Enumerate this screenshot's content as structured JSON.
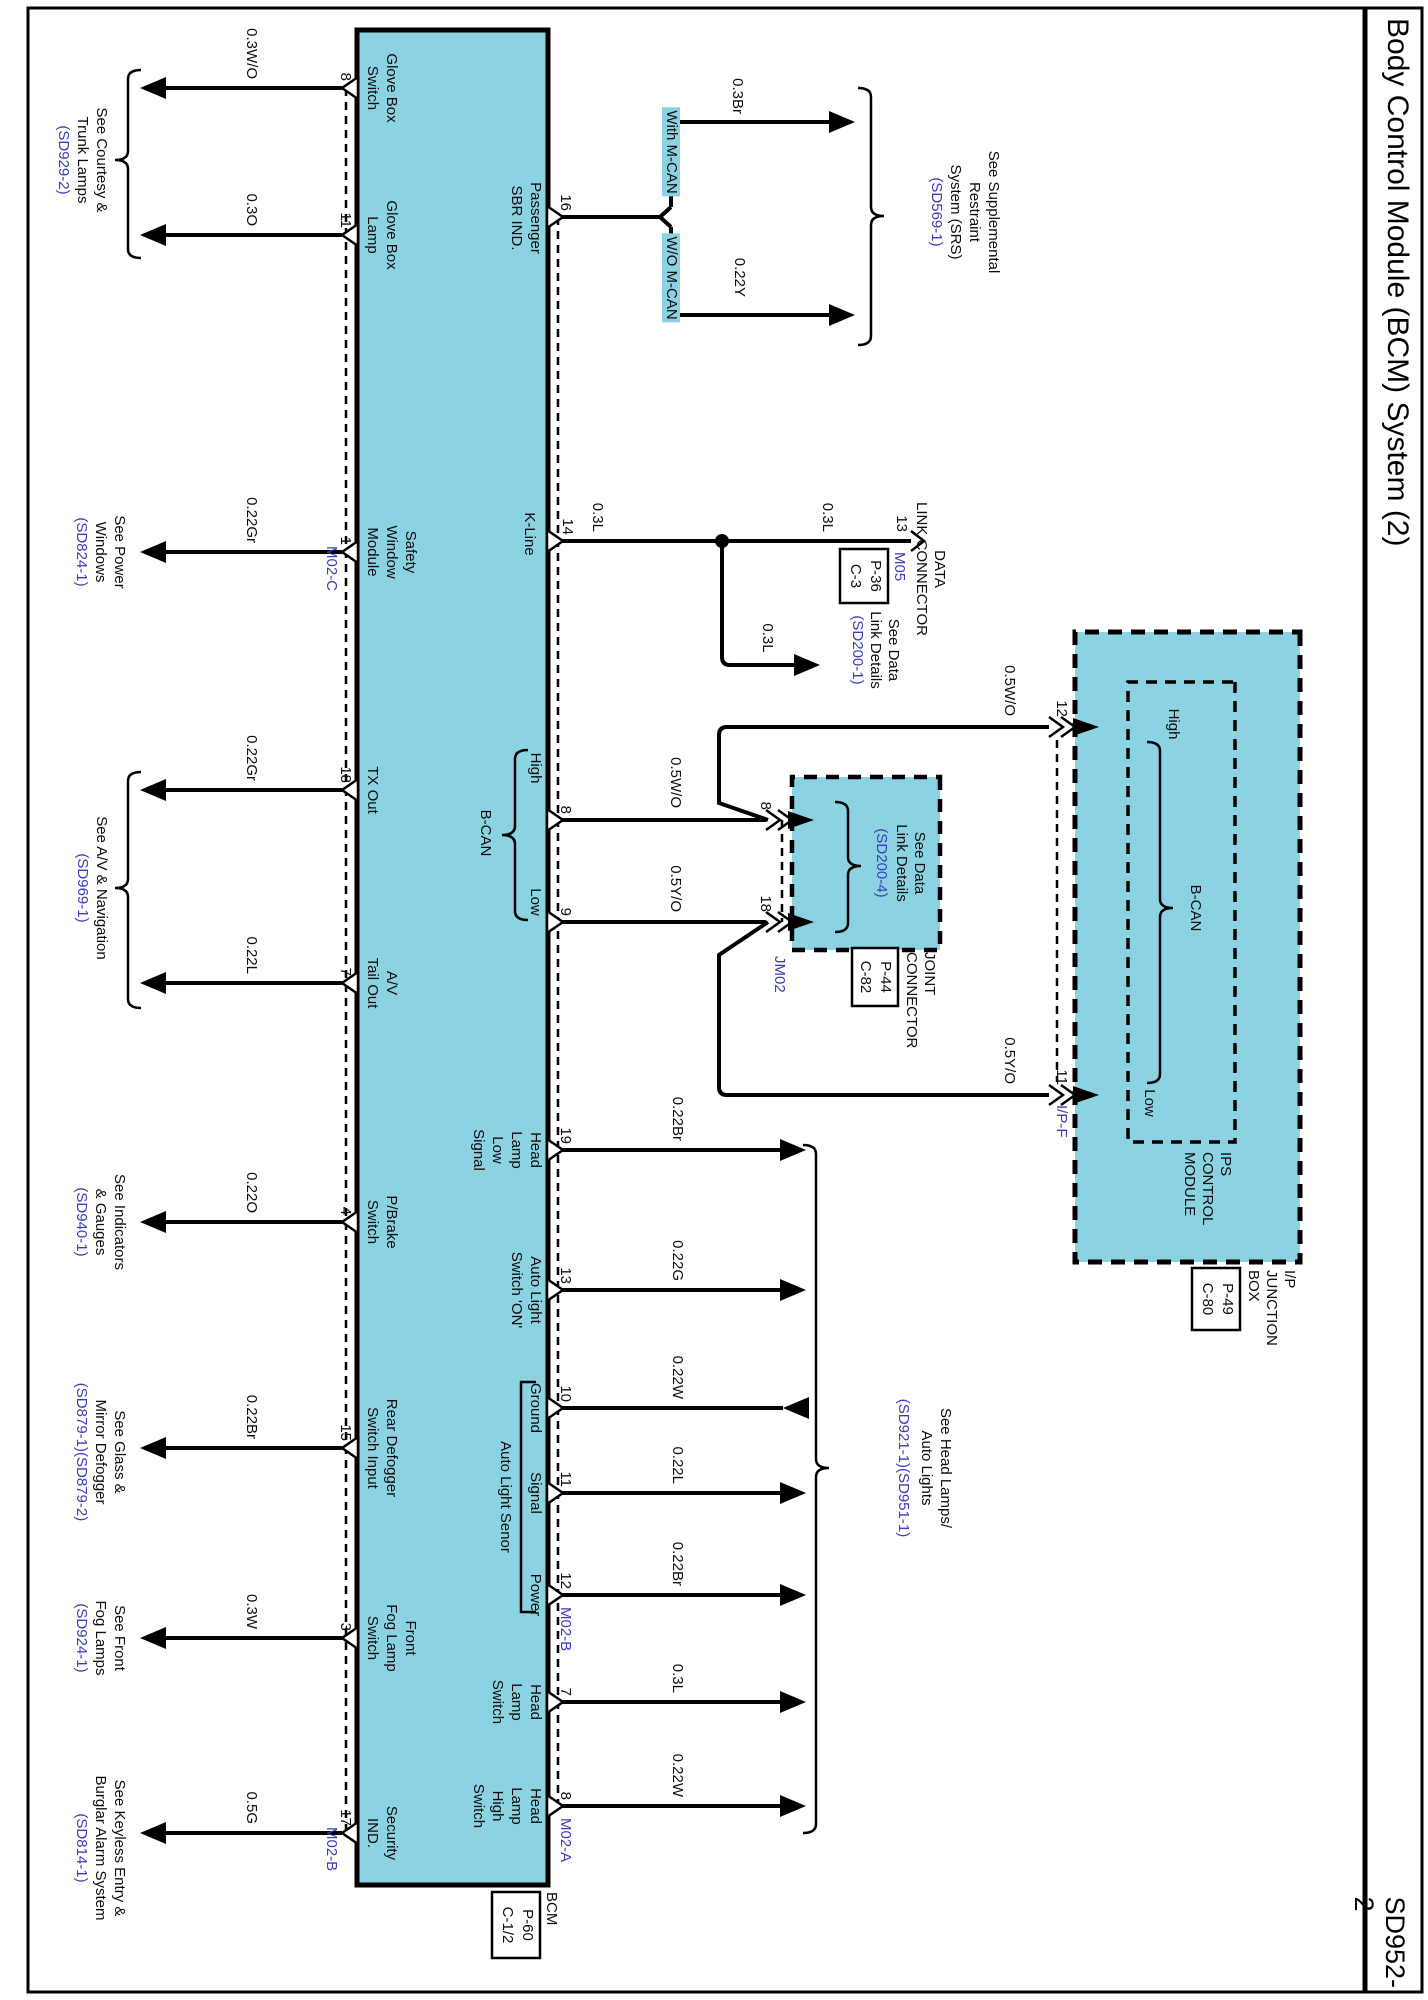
{
  "page": {
    "title": "Body Control Module (BCM) System (2)",
    "code": "SD952-2"
  },
  "colors": {
    "module_fill": "#8bd2e2",
    "reference_blue": "#3b3bbc",
    "wire_black": "#000000"
  },
  "bcm": {
    "label": "BCM",
    "connector_box": [
      "P-60",
      "C-1/2"
    ],
    "bottom_pins": [
      {
        "num": "8",
        "wire": "0.3W/O",
        "name": [
          "Glove Box",
          "Switch"
        ]
      },
      {
        "num": "11",
        "wire": "0.3O",
        "name": [
          "Glove Box",
          "Lamp"
        ]
      },
      {
        "num": "1",
        "wire": "0.22Gr",
        "name": [
          "Safety",
          "Window",
          "Module"
        ],
        "conn": "M02-C"
      },
      {
        "num": "18",
        "wire": "0.22Gr",
        "name": [
          "TX Out"
        ]
      },
      {
        "num": "7",
        "wire": "0.22L",
        "name": [
          "A/V",
          "Tail Out"
        ]
      },
      {
        "num": "4",
        "wire": "0.22O",
        "name": [
          "P/Brake",
          "Switch"
        ]
      },
      {
        "num": "15",
        "wire": "0.22Br",
        "name": [
          "Rear Defogger",
          "Switch Input"
        ]
      },
      {
        "num": "3",
        "wire": "0.3W",
        "name": [
          "Front",
          "Fog Lamp",
          "Switch"
        ]
      },
      {
        "num": "17",
        "wire": "0.5G",
        "name": [
          "Security",
          "IND."
        ],
        "conn": "M02-B"
      }
    ],
    "bottom_refs": [
      {
        "lines": [
          "See Courtesy &",
          "Trunk Lamps"
        ],
        "code": "(SD929-2)"
      },
      {
        "lines": [
          "See Power",
          "Windows"
        ],
        "code": "(SD824-1)"
      },
      {
        "lines": [
          "See A/V & Navigation"
        ],
        "code": "(SD969-1)"
      },
      {
        "lines": [
          "See Indicators",
          "& Gauges"
        ],
        "code": "(SD940-1)"
      },
      {
        "lines": [
          "See Glass &",
          "Mirror Defogger"
        ],
        "code": "(SD879-1)(SD879-2)"
      },
      {
        "lines": [
          "See Front",
          "Fog Lamps"
        ],
        "code": "(SD924-1)"
      },
      {
        "lines": [
          "See Keyless Entry &",
          "Burglar Alarm System"
        ],
        "code": "(SD814-1)"
      }
    ],
    "headlamp_pins": [
      {
        "num": "19",
        "wire": "0.22Br",
        "name": [
          "Head",
          "Lamp",
          "Low",
          "Signal"
        ]
      },
      {
        "num": "13",
        "wire": "0.22G",
        "name": [
          "Auto Light",
          "Switch 'ON'"
        ]
      },
      {
        "num": "10",
        "wire": "0.22W",
        "name": [
          "Ground"
        ],
        "dir": "in"
      },
      {
        "num": "11",
        "wire": "0.22L",
        "name": [
          "Signal"
        ]
      },
      {
        "num": "12",
        "wire": "0.22Br",
        "name": [
          "Power"
        ],
        "conn": "M02-B"
      },
      {
        "num": "7",
        "wire": "0.3L",
        "name": [
          "Head",
          "Lamp",
          "Switch"
        ]
      },
      {
        "num": "8",
        "wire": "0.22W",
        "name": [
          "Head",
          "Lamp",
          "High",
          "Switch"
        ],
        "conn": "M02-A"
      }
    ],
    "headlamp_ref": {
      "lines": [
        "See Head Lamps/",
        "Auto Lights"
      ],
      "code": "(SD921-1)(SD951-1)"
    },
    "sensor_group": "Auto Light Senor"
  },
  "srs": {
    "pin": {
      "num": "16",
      "name": [
        "Passenger",
        "SBR IND."
      ]
    },
    "branches": [
      {
        "tag": "With M-CAN",
        "wire": "0.3Br"
      },
      {
        "tag": "W/O M-CAN",
        "wire": "0.22Y"
      }
    ],
    "ref": {
      "lines": [
        "See Supplemental",
        "Restraint",
        "System (SRS)"
      ],
      "code": "(SD569-1)"
    }
  },
  "dlc": {
    "pin": {
      "num": "14",
      "name": "K-Line"
    },
    "wire": "0.3L",
    "connector": {
      "num": "13",
      "name": [
        "DATA",
        "LINK CONNECTOR"
      ],
      "id": "M05",
      "box": [
        "P-36",
        "C-3"
      ]
    },
    "branch": {
      "wire": "0.3L",
      "ref": {
        "lines": [
          "See Data",
          "Link Details"
        ],
        "code": "(SD200-1)"
      }
    }
  },
  "bcan": {
    "high": {
      "num": "8",
      "wire": "0.5W/O",
      "label": "High"
    },
    "low": {
      "num": "9",
      "wire": "0.5Y/O",
      "label": "Low"
    },
    "group": "B-CAN"
  },
  "jm02": {
    "pins": [
      {
        "num": "8"
      },
      {
        "num": "18"
      }
    ],
    "id": "JM02",
    "ref": {
      "lines": [
        "See Data",
        "Link Details"
      ],
      "code": "(SD200-4)"
    },
    "connector_name": [
      "JOINT",
      "CONNECTOR"
    ],
    "connector_box": [
      "P-44",
      "C-82"
    ],
    "out_wires": [
      {
        "wire": "0.5W/O"
      },
      {
        "wire": "0.5Y/O"
      }
    ]
  },
  "ips": {
    "pins": [
      {
        "num": "12",
        "label": "High"
      },
      {
        "num": "11",
        "label": "Low",
        "conn": "I/P-F"
      }
    ],
    "group": "B-CAN",
    "module_name": [
      "IPS",
      "CONTROL",
      "MODULE"
    ],
    "junction_name": [
      "I/P",
      "JUNCTION",
      "BOX"
    ],
    "junction_box": [
      "P-49",
      "C-80"
    ]
  }
}
